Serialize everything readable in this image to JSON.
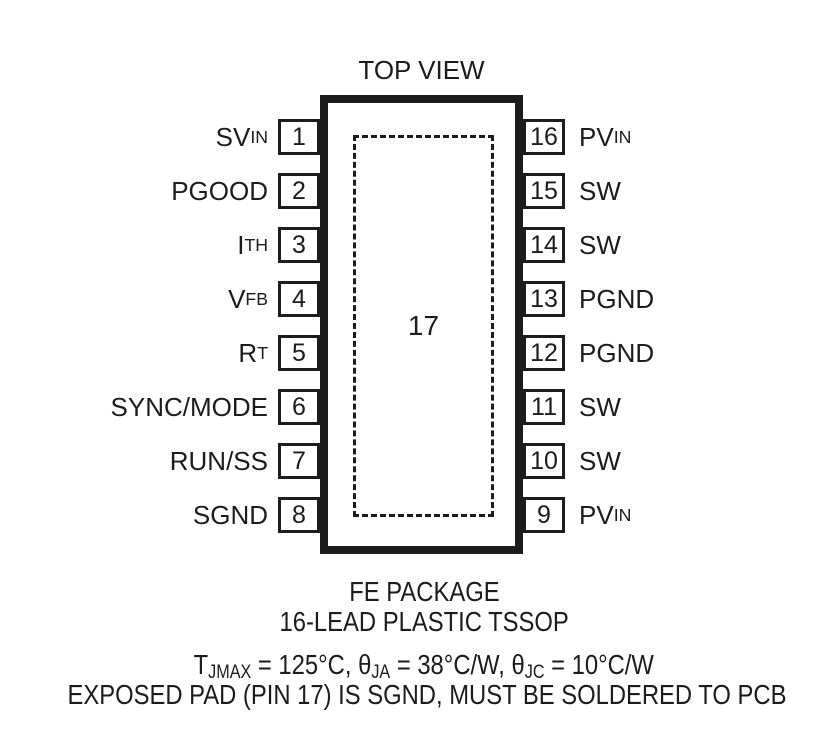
{
  "figure": {
    "title": "TOP VIEW",
    "colors": {
      "ink": "#1c1c1c",
      "background": "#ffffff"
    },
    "package": {
      "center_pad": {
        "number": "17"
      },
      "left_pins": [
        {
          "number": "1",
          "label": "SV",
          "label_sub": "IN"
        },
        {
          "number": "2",
          "label": "PGOOD",
          "label_sub": ""
        },
        {
          "number": "3",
          "label": "I",
          "label_sub": "TH"
        },
        {
          "number": "4",
          "label": "V",
          "label_sub": "FB"
        },
        {
          "number": "5",
          "label": "R",
          "label_sub": "T"
        },
        {
          "number": "6",
          "label": "SYNC/MODE",
          "label_sub": ""
        },
        {
          "number": "7",
          "label": "RUN/SS",
          "label_sub": ""
        },
        {
          "number": "8",
          "label": "SGND",
          "label_sub": ""
        }
      ],
      "right_pins": [
        {
          "number": "16",
          "label": "PV",
          "label_sub": "IN"
        },
        {
          "number": "15",
          "label": "SW",
          "label_sub": ""
        },
        {
          "number": "14",
          "label": "SW",
          "label_sub": ""
        },
        {
          "number": "13",
          "label": "PGND",
          "label_sub": ""
        },
        {
          "number": "12",
          "label": "PGND",
          "label_sub": ""
        },
        {
          "number": "11",
          "label": "SW",
          "label_sub": ""
        },
        {
          "number": "10",
          "label": "SW",
          "label_sub": ""
        },
        {
          "number": "9",
          "label": "PV",
          "label_sub": "IN"
        }
      ]
    },
    "captions": {
      "package_name": "FE PACKAGE",
      "package_type": "16-LEAD PLASTIC TSSOP",
      "thermal": {
        "segments": [
          {
            "text": "T"
          },
          {
            "sub": "JMAX"
          },
          {
            "text": " = 125°C, θ"
          },
          {
            "sub": "JA"
          },
          {
            "text": " = 38°C/W, θ"
          },
          {
            "sub": "JC"
          },
          {
            "text": " = 10°C/W"
          }
        ]
      },
      "exposed_pad_note": "EXPOSED PAD (PIN 17) IS SGND, MUST BE SOLDERED TO PCB"
    }
  }
}
